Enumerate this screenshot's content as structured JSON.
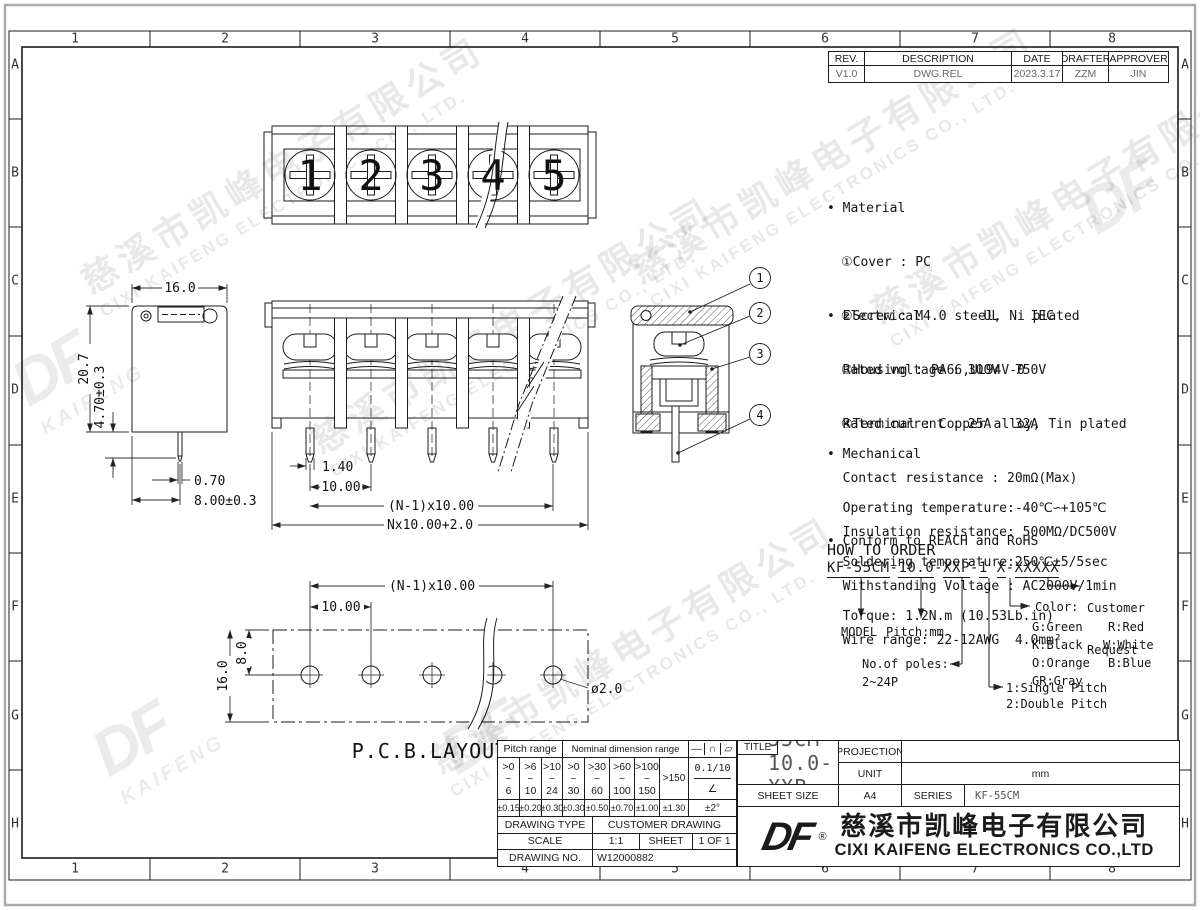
{
  "border": {
    "columns": [
      "1",
      "2",
      "3",
      "4",
      "5",
      "6",
      "7",
      "8"
    ],
    "rows": [
      "A",
      "B",
      "C",
      "D",
      "E",
      "F",
      "G",
      "H"
    ]
  },
  "revision_table": {
    "headers": [
      "REV.",
      "DESCRIPTION",
      "DATE",
      "DRAFTER",
      "APPROVER"
    ],
    "row": [
      "V1.0",
      "DWG.REL",
      "2023.3.17",
      "ZZM",
      "JIN"
    ]
  },
  "notes": {
    "material_title": "• Material",
    "material_items": [
      "①Cover : PC",
      "②Screw : M4.0 steel, Ni plated",
      "③Housing : PA66,UL94V-0",
      "④Terminal : Copper alloy, Tin plated"
    ],
    "electrical_title": "• Electrical        UL    IEC",
    "electrical_items": [
      "  Rated voltage : 300V  750V",
      "  Rated current : 25A   32A",
      "  Contact resistance : 20mΩ(Max)",
      "  Insulation resistance: 500MΩ/DC500V",
      "  Withstanding Voltage : AC2000V/1min",
      "  Wire range: 22-12AWG  4.0mm²"
    ],
    "mechanical_title": "• Mechanical",
    "mechanical_items": [
      "  Operating temperature:-40℃∽+105℃",
      "  Soldering temperature:250℃±5/5sec",
      "  Torque: 1.2N.m (10.53Lb.in)"
    ],
    "conform": "• Conform to REACH and RoHS"
  },
  "how_to_order": {
    "title": "HOW TO ORDER",
    "segments": [
      "KF-55CM",
      "-",
      "10.0",
      "-",
      "XXP",
      "-",
      "1",
      " ",
      "X",
      "-",
      "XXXXX"
    ],
    "model_label": "MODEL",
    "pitch_label": "Pitch:mm",
    "poles_label": "No.of poles:",
    "poles_value": "2~24P",
    "pitch_type_1": "1:Single Pitch",
    "pitch_type_2": "2:Double Pitch",
    "color_label": "Color:",
    "colors": [
      "G:Green",
      "R:Red",
      "K:Black",
      "W:White",
      "O:Orange",
      "B:Blue",
      "GR:Gray"
    ],
    "customer_1": "Customer",
    "customer_2": "Request"
  },
  "drawing": {
    "screws": [
      "1",
      "2",
      "3",
      "4",
      "5"
    ],
    "callouts": [
      "1",
      "2",
      "3",
      "4"
    ],
    "left_view": {
      "width": "16.0",
      "height": "20.7",
      "pin_len": "4.70±0.3",
      "pin_w": "0.70",
      "pin_pos": "8.00±0.3"
    },
    "front_view": {
      "pin_w": "1.40",
      "pitch": "10.00",
      "span": "(N-1)x10.00",
      "total": "Nx10.00+2.0"
    },
    "pcb": {
      "span": "(N-1)x10.00",
      "pitch": "10.00",
      "hole_y": "8.0",
      "height": "16.0",
      "hole_d": "ø2.0",
      "label": "P.C.B.LAYOUT"
    }
  },
  "tolerance_table": {
    "pitch_header": "Pitch range",
    "nominal_header": "Nominal dimension range",
    "ranges": [
      [
        ">0",
        "~",
        "6"
      ],
      [
        ">6",
        "~",
        "10"
      ],
      [
        ">10",
        "~",
        "24"
      ],
      [
        ">0",
        "~",
        "30"
      ],
      [
        ">30",
        "~",
        "60"
      ],
      [
        ">60",
        "~",
        "100"
      ],
      [
        ">100",
        "~",
        "150"
      ]
    ],
    "range_last": ">150",
    "tolerances": [
      "±0.15",
      "±0.20",
      "±0.30",
      "±0.30",
      "±0.50",
      "±0.70",
      "±1.00",
      "±1.30"
    ],
    "symbols": [
      "—",
      "∩",
      "▱"
    ],
    "flatness": "0.1/10",
    "angle_symbol": "∠",
    "angle_tolerance": "±2°",
    "drawing_type_label": "DRAWING TYPE",
    "drawing_type": "CUSTOMER DRAWING",
    "scale_label": "SCALE",
    "scale": "1:1",
    "sheet_label": "SHEET",
    "sheet": "1 OF 1",
    "drawing_no_label": "DRAWING NO.",
    "drawing_no": "W12000882"
  },
  "title_block": {
    "projection_label": "PROJECTION",
    "title_label": "TITLE",
    "title": "KF-55CM-10.0-XXP-1X",
    "unit_label": "UNIT",
    "unit": "mm",
    "sheet_size_label": "SHEET SIZE",
    "sheet_size": "A4",
    "series_label": "SERIES",
    "series": "KF-55CM",
    "logo_text": "DF",
    "registered": "®",
    "company_cn": "慈溪市凯峰电子有限公司",
    "company_en": "CIXI KAIFENG ELECTRONICS CO.,LTD"
  },
  "watermark": {
    "cn": "慈溪市凯峰电子有限公司",
    "en": "CIXI KAIFENG ELECTRONICS CO., LTD.",
    "logo": "DF",
    "logo_sub": "KAIFENG"
  }
}
